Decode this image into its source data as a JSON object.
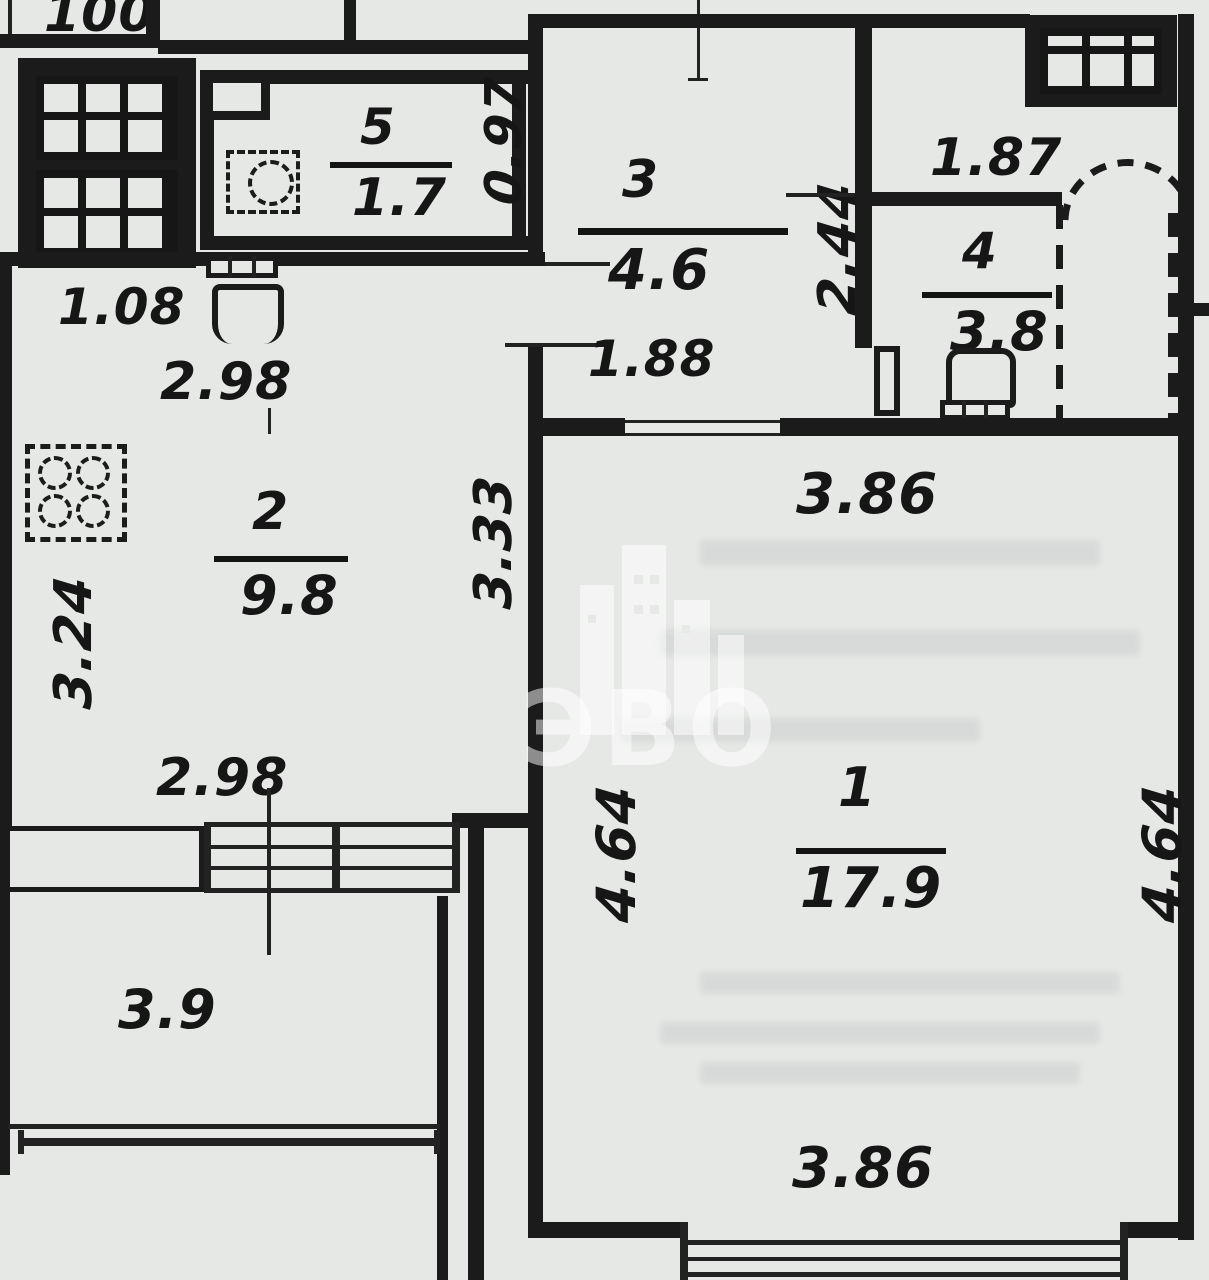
{
  "watermark_text": "ЭВО",
  "rooms": {
    "r1": {
      "number": "1",
      "area": "17.9"
    },
    "r2": {
      "number": "2",
      "area": "9.8"
    },
    "r3": {
      "number": "3",
      "area": "4.6"
    },
    "r4": {
      "number": "4",
      "area": "3.8"
    },
    "r5": {
      "number": "5",
      "area": "1.7"
    },
    "balcony": {
      "area": "3.9"
    }
  },
  "dimensions": {
    "top_partial": "100",
    "w097": "0.97",
    "h244": "2.44",
    "w187": "1.87",
    "w188": "1.88",
    "w108": "1.08",
    "w298_top": "2.98",
    "h324": "3.24",
    "h333": "3.33",
    "w298_bottom": "2.98",
    "w386_top": "3.86",
    "h464_left": "4.64",
    "h464_right": "4.64",
    "w386_bottom": "3.86"
  }
}
